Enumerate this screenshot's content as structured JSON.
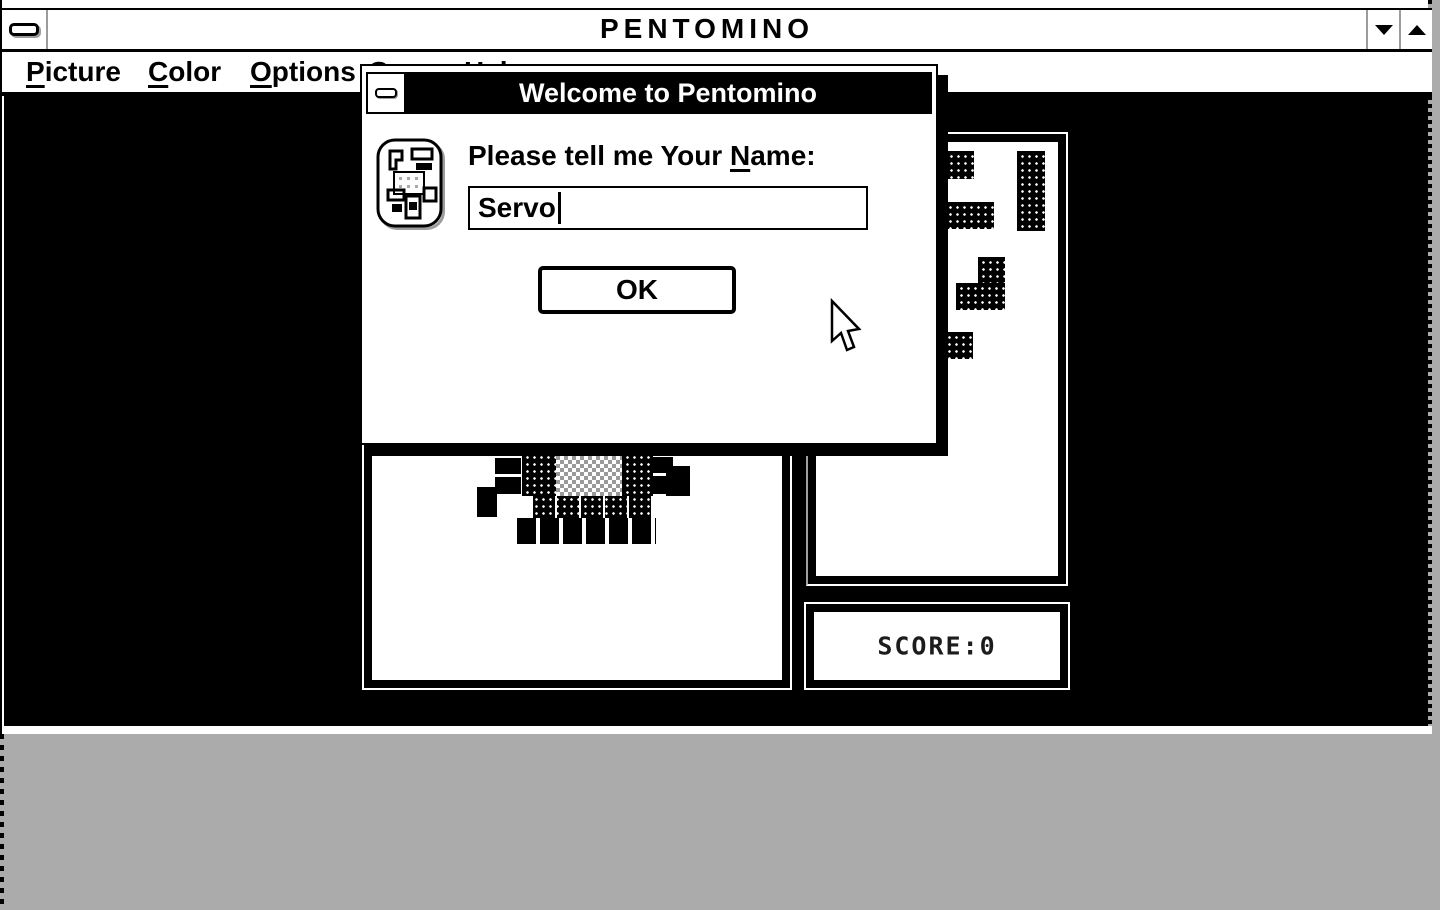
{
  "window": {
    "title": "PENTOMINO",
    "icons": {
      "system_menu": "system-menu-dash",
      "minimize": "down-triangle",
      "maximize": "up-triangle"
    }
  },
  "menu_bar": {
    "items": [
      {
        "accel": "P",
        "rest": "icture"
      },
      {
        "accel": "C",
        "rest": "olor"
      },
      {
        "accel": "O",
        "rest": "ptions"
      },
      {
        "accel": "G",
        "rest": "ame"
      },
      {
        "accel": "H",
        "rest": "elp"
      }
    ]
  },
  "dialog": {
    "title": "Welcome to Pentomino",
    "prompt_prefix": "Please tell me Your ",
    "prompt_accel": "N",
    "prompt_suffix": "ame:",
    "name_value": "Servo",
    "ok_label": "OK"
  },
  "score_panel": {
    "text": "SCORE:0"
  },
  "colors": {
    "desktop_gray": "#ababab",
    "black": "#000000",
    "white": "#ffffff"
  }
}
